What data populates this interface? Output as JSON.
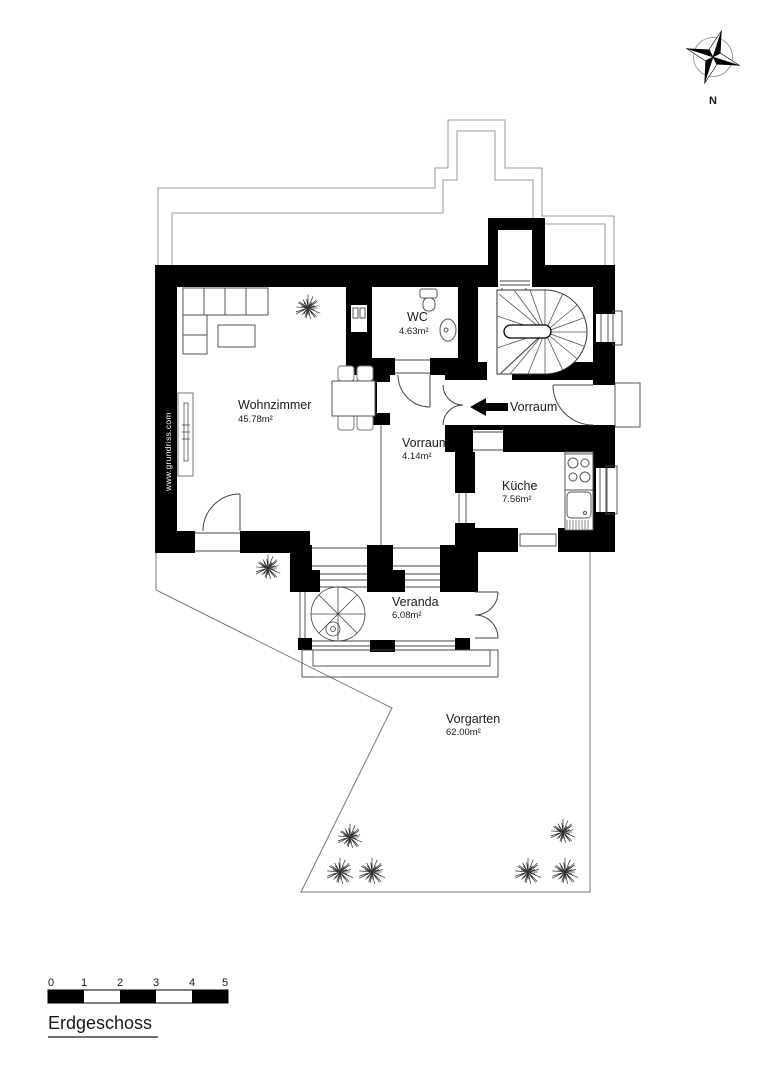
{
  "compass": {
    "north_label": "N"
  },
  "watermark": "www.grundriss.com",
  "rooms": {
    "wohnzimmer": {
      "name": "Wohnzimmer",
      "area": "45.78m²"
    },
    "wc": {
      "name": "WC",
      "area": "4.63m²"
    },
    "vorraum_entry": {
      "name": "Vorraum",
      "area": ""
    },
    "vorraum": {
      "name": "Vorraum",
      "area": "4.14m²"
    },
    "kueche": {
      "name": "Küche",
      "area": "7.56m²"
    },
    "veranda": {
      "name": "Veranda",
      "area": "6.08m²"
    },
    "vorgarten": {
      "name": "Vorgarten",
      "area": "62.00m²"
    }
  },
  "scale_bar": {
    "labels": [
      "0",
      "1",
      "2",
      "3",
      "4",
      "5"
    ]
  },
  "floor_title": "Erdgeschoss",
  "colors": {
    "wall": "#000000",
    "outline": "#999999",
    "thin": "#444444",
    "text": "#1a1a1a"
  }
}
